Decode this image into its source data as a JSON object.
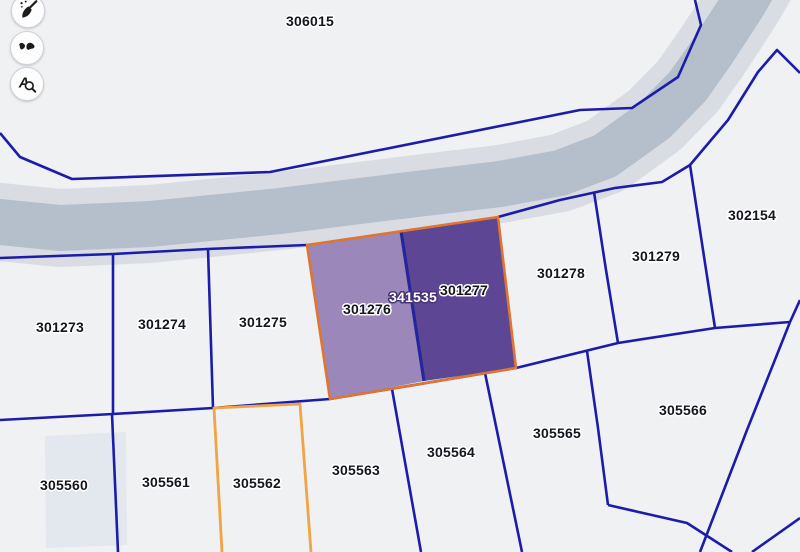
{
  "app": {
    "title": "Cadastral map viewer"
  },
  "toolbar": {
    "buttons": [
      {
        "id": "clear-selection-button",
        "icon": "broom-icon",
        "label": "Clear"
      },
      {
        "id": "map-features-button",
        "icon": "shapes-icon",
        "label": "Features"
      },
      {
        "id": "label-search-button",
        "icon": "text-search-icon",
        "label": "Search labels"
      }
    ]
  },
  "map": {
    "background": "#eff1f3",
    "line_color": "#1c1caa",
    "line_width": 2.6,
    "label_color": "#15151e",
    "label_halo": "#ffffff",
    "road": {
      "color": "#b5bfcb",
      "halo_color": "#d9dde3",
      "width": 46,
      "halo_width": 78,
      "points": [
        [
          -20,
          220
        ],
        [
          60,
          228
        ],
        [
          150,
          224
        ],
        [
          280,
          211
        ],
        [
          400,
          196
        ],
        [
          500,
          184
        ],
        [
          560,
          173
        ],
        [
          605,
          156
        ],
        [
          655,
          120
        ],
        [
          688,
          86
        ],
        [
          712,
          52
        ],
        [
          742,
          6
        ],
        [
          756,
          -18
        ]
      ]
    },
    "building": {
      "fill": "#e3e7ee",
      "points": [
        [
          45,
          436
        ],
        [
          126,
          432
        ],
        [
          127,
          545
        ],
        [
          46,
          548
        ]
      ]
    },
    "boundaries": [
      {
        "name": "parcel-306015-boundary",
        "points": [
          [
            0,
            133
          ],
          [
            20,
            157
          ],
          [
            72,
            179
          ],
          [
            270,
            172
          ],
          [
            580,
            110
          ],
          [
            632,
            108
          ],
          [
            678,
            77
          ],
          [
            701,
            25
          ],
          [
            695,
            0
          ]
        ]
      },
      {
        "name": "middle-row-top-boundary",
        "points": [
          [
            0,
            258
          ],
          [
            113,
            254
          ],
          [
            207,
            249
          ],
          [
            307,
            245
          ]
        ]
      },
      {
        "name": "right-parcels-top-boundary",
        "points": [
          [
            498,
            217
          ],
          [
            560,
            200
          ],
          [
            615,
            188
          ],
          [
            662,
            182
          ],
          [
            690,
            165
          ],
          [
            728,
            120
          ],
          [
            758,
            72
          ],
          [
            777,
            50
          ],
          [
            800,
            73
          ]
        ]
      },
      {
        "name": "middle-row-bottom-diagonal",
        "points": [
          [
            0,
            420
          ],
          [
            113,
            414
          ],
          [
            213,
            408
          ],
          [
            330,
            399
          ],
          [
            516,
            368
          ],
          [
            618,
            343
          ],
          [
            715,
            328
          ],
          [
            790,
            322
          ]
        ]
      },
      {
        "name": "parcel-302154-right-stub",
        "points": [
          [
            790,
            322
          ],
          [
            800,
            300
          ]
        ]
      },
      {
        "name": "parcel-305566-right-boundary",
        "points": [
          [
            790,
            322
          ],
          [
            747,
            430
          ],
          [
            700,
            552
          ]
        ]
      },
      {
        "name": "parcel-305566-bottom-boundary",
        "points": [
          [
            608,
            505
          ],
          [
            687,
            523
          ],
          [
            732,
            552
          ]
        ]
      },
      {
        "name": "corner-boundary",
        "points": [
          [
            800,
            518
          ],
          [
            752,
            552
          ]
        ]
      },
      {
        "name": "divider-305565-305566",
        "points": [
          [
            587,
            351
          ],
          [
            598,
            428
          ],
          [
            608,
            505
          ]
        ]
      },
      {
        "name": "divider-301273-301274",
        "points": [
          [
            113,
            254
          ],
          [
            113,
            414
          ]
        ]
      },
      {
        "name": "divider-301274-301275",
        "points": [
          [
            208,
            249
          ],
          [
            213,
            408
          ]
        ]
      },
      {
        "name": "divider-301278-301279",
        "points": [
          [
            594,
            192
          ],
          [
            606,
            270
          ],
          [
            618,
            343
          ]
        ]
      },
      {
        "name": "divider-301279-302154",
        "points": [
          [
            690,
            165
          ],
          [
            703,
            250
          ],
          [
            715,
            328
          ]
        ]
      },
      {
        "name": "divider-305560-305561",
        "points": [
          [
            112,
            414
          ],
          [
            118,
            552
          ]
        ]
      },
      {
        "name": "divider-305563-305564",
        "points": [
          [
            392,
            389
          ],
          [
            421,
            552
          ]
        ]
      },
      {
        "name": "divider-305564-305565",
        "points": [
          [
            485,
            373
          ],
          [
            522,
            552
          ]
        ]
      }
    ],
    "selected_parcels": {
      "outline_color": "#e0752f",
      "outline_width": 2.6,
      "outline_points": [
        [
          307,
          245
        ],
        [
          498,
          217
        ],
        [
          516,
          368
        ],
        [
          330,
          399
        ]
      ],
      "left": {
        "id": "301276",
        "fill": "#9b87b9",
        "points": [
          [
            307,
            245
          ],
          [
            401,
            231
          ],
          [
            424,
            381
          ],
          [
            330,
            399
          ]
        ]
      },
      "right": {
        "id": "301277",
        "fill": "#5d4694",
        "points": [
          [
            401,
            231
          ],
          [
            498,
            217
          ],
          [
            516,
            368
          ],
          [
            424,
            381
          ]
        ]
      },
      "divider": {
        "color": "#26269c",
        "width": 3.2,
        "points": [
          [
            401,
            231
          ],
          [
            424,
            381
          ]
        ]
      }
    },
    "orange_parcel": {
      "id": "305562",
      "stroke": "#f2a344",
      "width": 2.8,
      "points": [
        [
          222,
          552
        ],
        [
          214,
          408
        ],
        [
          300,
          404
        ],
        [
          311,
          552
        ]
      ]
    },
    "labels": [
      {
        "text": "306015",
        "x": 310,
        "y": 26
      },
      {
        "text": "302154",
        "x": 752,
        "y": 220
      },
      {
        "text": "301279",
        "x": 656,
        "y": 261
      },
      {
        "text": "301278",
        "x": 561,
        "y": 278
      },
      {
        "text": "301277",
        "x": 464,
        "y": 295
      },
      {
        "text": "341535",
        "x": 413,
        "y": 302,
        "style": "inverse"
      },
      {
        "text": "301276",
        "x": 367,
        "y": 314
      },
      {
        "text": "301275",
        "x": 263,
        "y": 327
      },
      {
        "text": "301274",
        "x": 162,
        "y": 329
      },
      {
        "text": "301273",
        "x": 60,
        "y": 332
      },
      {
        "text": "305566",
        "x": 683,
        "y": 415
      },
      {
        "text": "305565",
        "x": 557,
        "y": 438
      },
      {
        "text": "305564",
        "x": 451,
        "y": 457
      },
      {
        "text": "305563",
        "x": 356,
        "y": 475
      },
      {
        "text": "305562",
        "x": 257,
        "y": 488
      },
      {
        "text": "305561",
        "x": 166,
        "y": 487
      },
      {
        "text": "305560",
        "x": 64,
        "y": 490
      }
    ],
    "inverse_label": {
      "fill": "#ffffff",
      "halo": "#473376"
    }
  }
}
